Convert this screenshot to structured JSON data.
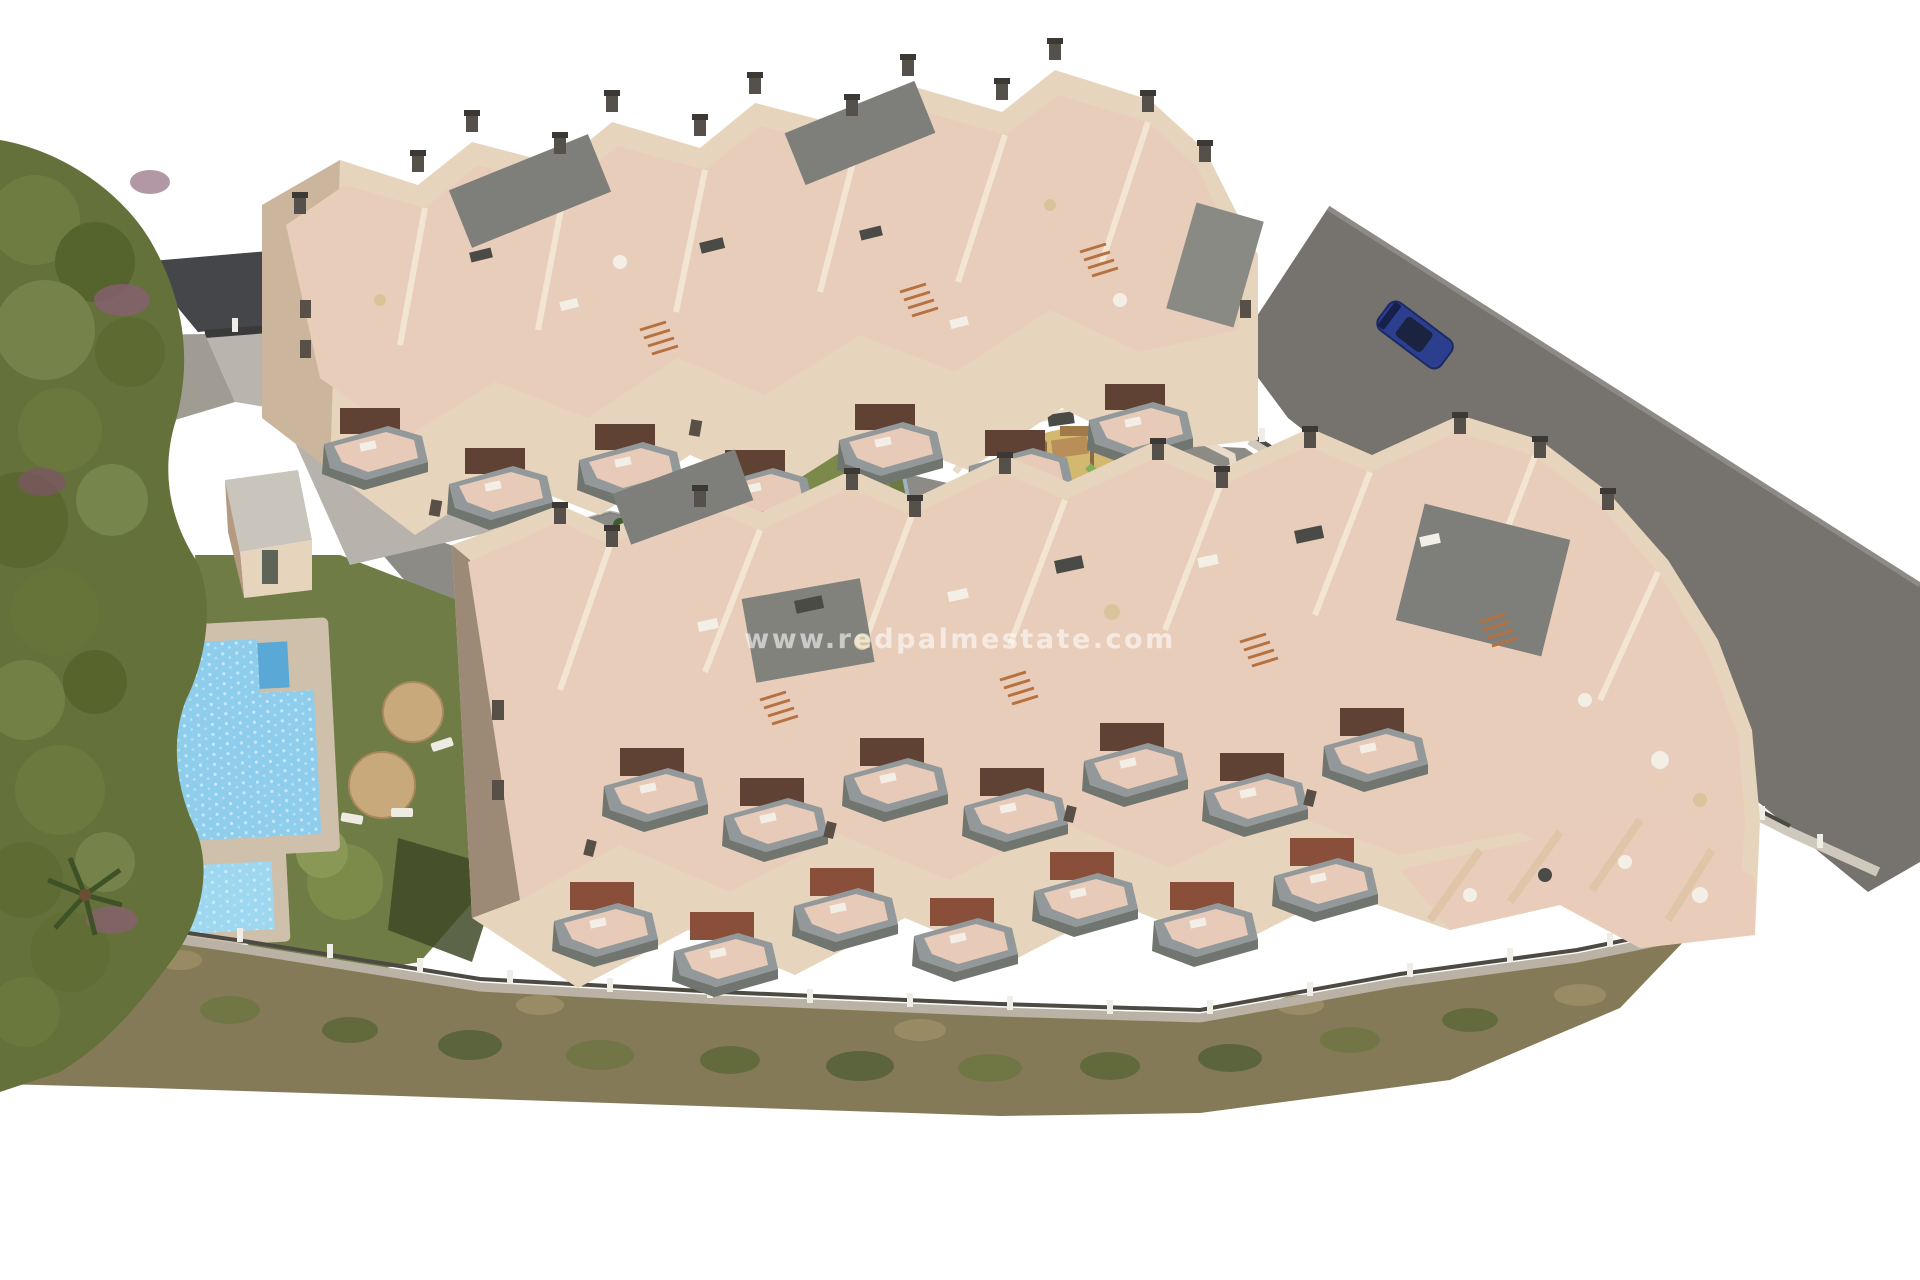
{
  "watermark": {
    "text": "www.redpalmestate.com"
  },
  "scene": {
    "description": "Aerial 3D architectural render of a terraced apartment complex with roof terraces, balconies, communal pool, lawn, playground, padel court and access road"
  },
  "colors": {
    "background": "#ffffff",
    "wall": "#e7d4bd",
    "wall_light": "#f1e3d0",
    "wall_shadow": "#b59a82",
    "terrace": "#e9cdbb",
    "terrace_low_wall": "#f2e6d2",
    "roof_gray": "#7e7e7a",
    "railing": "#93999a",
    "balcony_recess": "#5f4233",
    "road": "#76726d",
    "pavement": "#8c8b86",
    "lawn": "#6f7c46",
    "lawn_shadow": "#3f4a28",
    "pool_water": "#8ecdeb",
    "pool_kids": "#9ed7f0",
    "pool_step": "#59a8d6",
    "pool_deck": "#cfc0ac",
    "sand": "#d3b96f",
    "play_wood": "#b98e58",
    "scrub": "#857a57",
    "scrub_green": "#5d6838",
    "trees_base": "#64713a",
    "bush_purple": "#8a5f75",
    "umbrella": "#c8a97c",
    "stone_wall": "#b9b2a5",
    "fence_post": "#efede6",
    "neighbor_roof": "#45464a",
    "neighbor_yard": "#b9b5ae",
    "car": "#2b3f8e",
    "stair_wood": "#b5713f"
  }
}
